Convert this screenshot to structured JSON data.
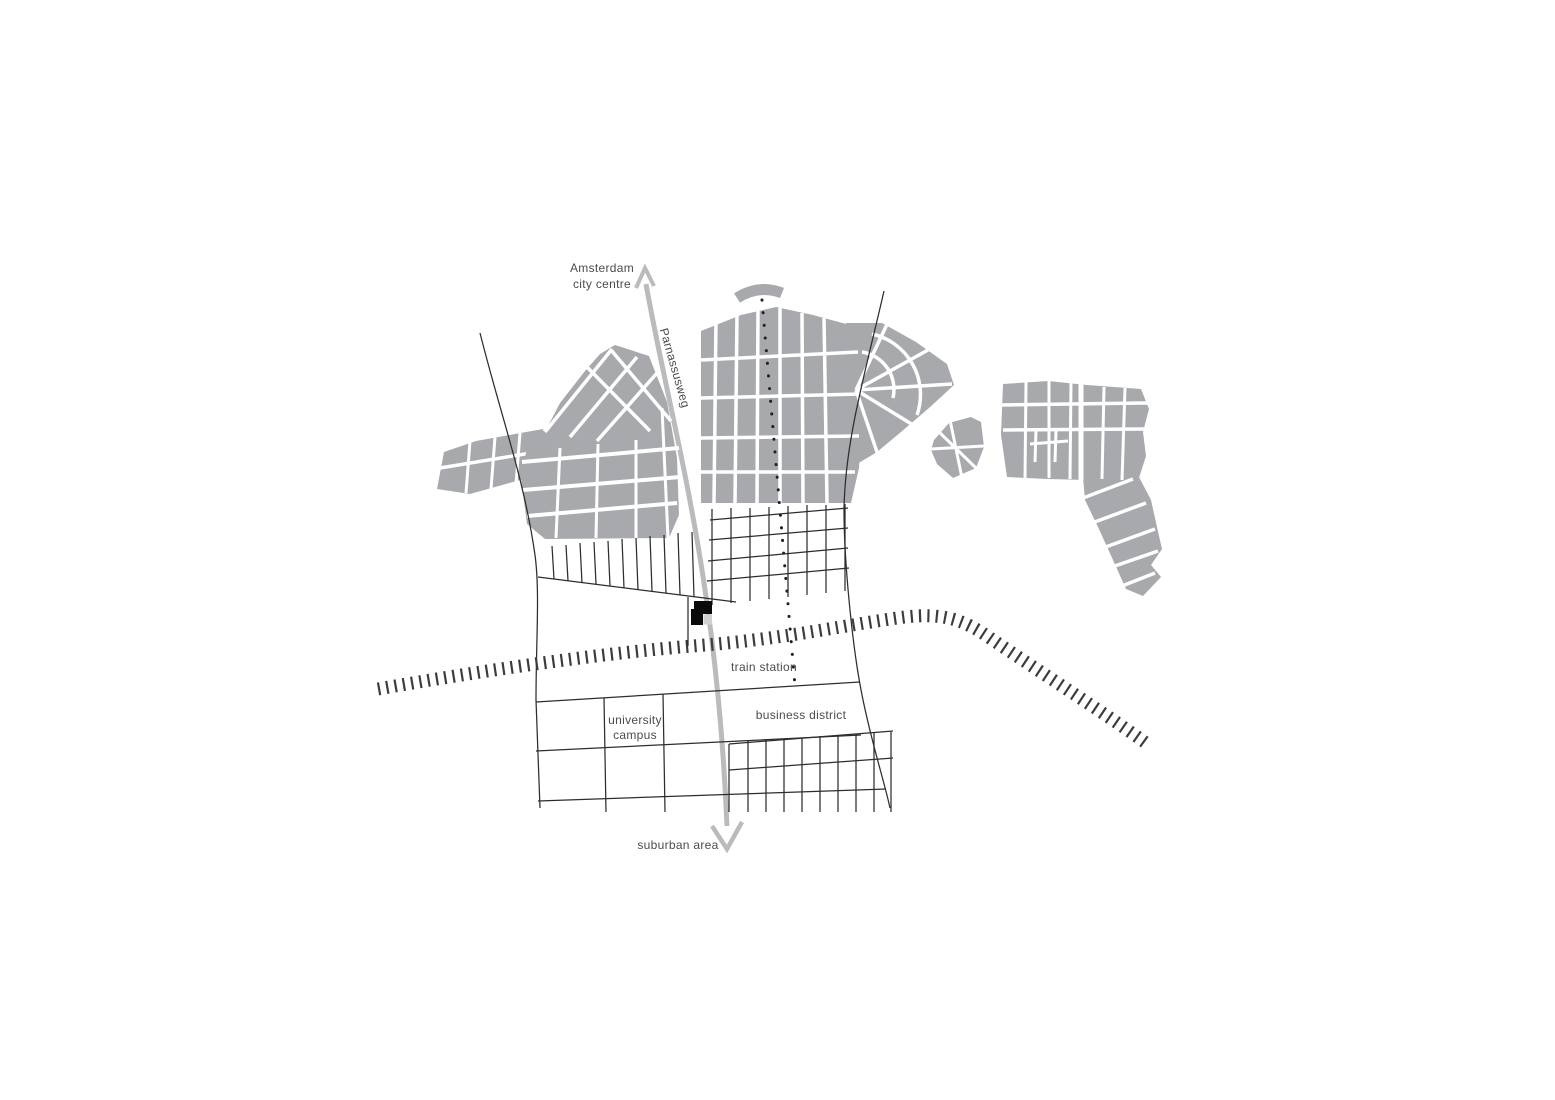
{
  "diagram": {
    "title": "urban site plan diagram",
    "labels": {
      "destination_top_line1": "Amsterdam",
      "destination_top_line2": "city centre",
      "road_name": "Parnassusweg",
      "train_station": "train station",
      "university_campus_line1": "university",
      "university_campus_line2": "campus",
      "business_district": "business district",
      "suburban_area": "suburban area"
    },
    "colors": {
      "background": "#ffffff",
      "city_block_gray": "#a7a9ac",
      "road_arrow_gray": "#b9bbbd",
      "line_black": "#2d2d2f",
      "railway_dark": "#3c3c3e",
      "site_building_black": "#0a0a0a",
      "site_building_light_gray": "#cfd0d2",
      "label_text": "#4b4c4e"
    },
    "legend_semantics": {
      "black_marker": "project site building",
      "hatched_band": "railway line",
      "gray_arrow": "Parnassusweg road axis from Amsterdam city centre to suburban area",
      "gray_shapes": "existing urban fabric"
    }
  }
}
